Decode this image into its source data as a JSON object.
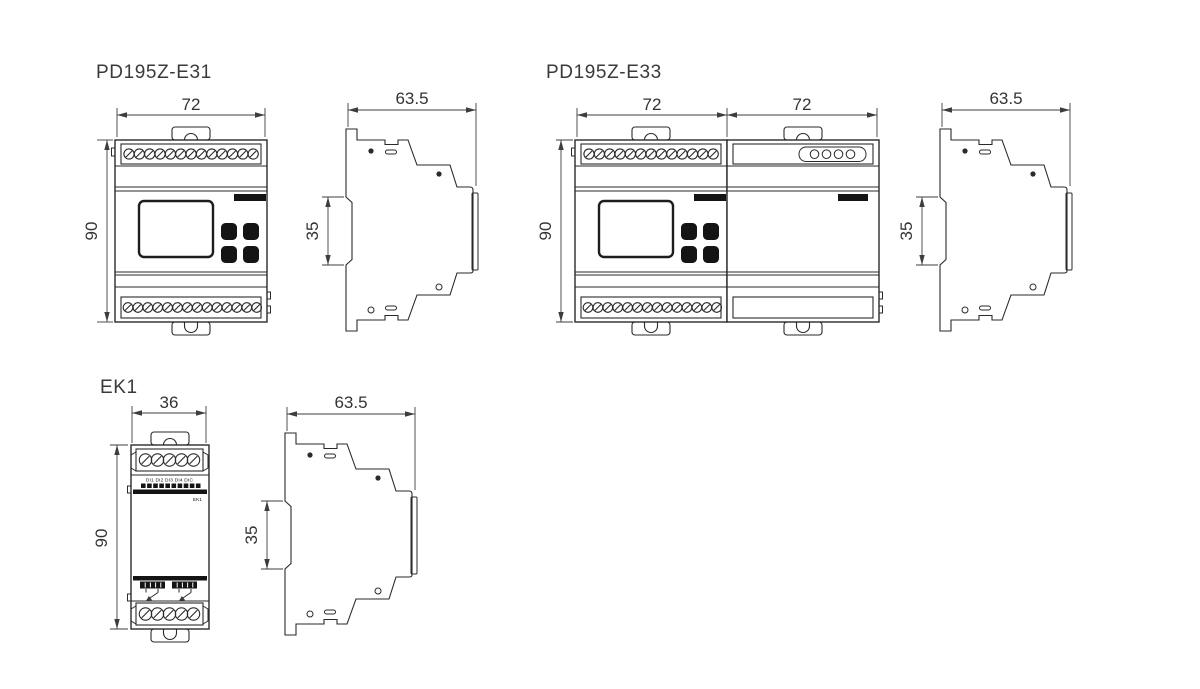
{
  "background": "#ffffff",
  "colors": {
    "line": "#2a2a2a",
    "dimension": "#3d3d3d",
    "solid_fill": "#141414",
    "text": "#333333"
  },
  "e31": {
    "title": "PD195Z-E31",
    "front": {
      "width": "72",
      "height": "90"
    },
    "side": {
      "depth": "63.5",
      "rail": "35"
    }
  },
  "e33": {
    "title": "PD195Z-E33",
    "front": {
      "width_left": "72",
      "width_right": "72",
      "height": "90"
    },
    "side": {
      "depth": "63.5",
      "rail": "35"
    }
  },
  "ek1": {
    "title": "EK1",
    "front": {
      "width": "36",
      "height": "90",
      "input_labels": "DI1 DI2 DI3 DI4 DIC",
      "model": "EK1"
    },
    "side": {
      "depth": "63.5",
      "rail": "35"
    }
  }
}
